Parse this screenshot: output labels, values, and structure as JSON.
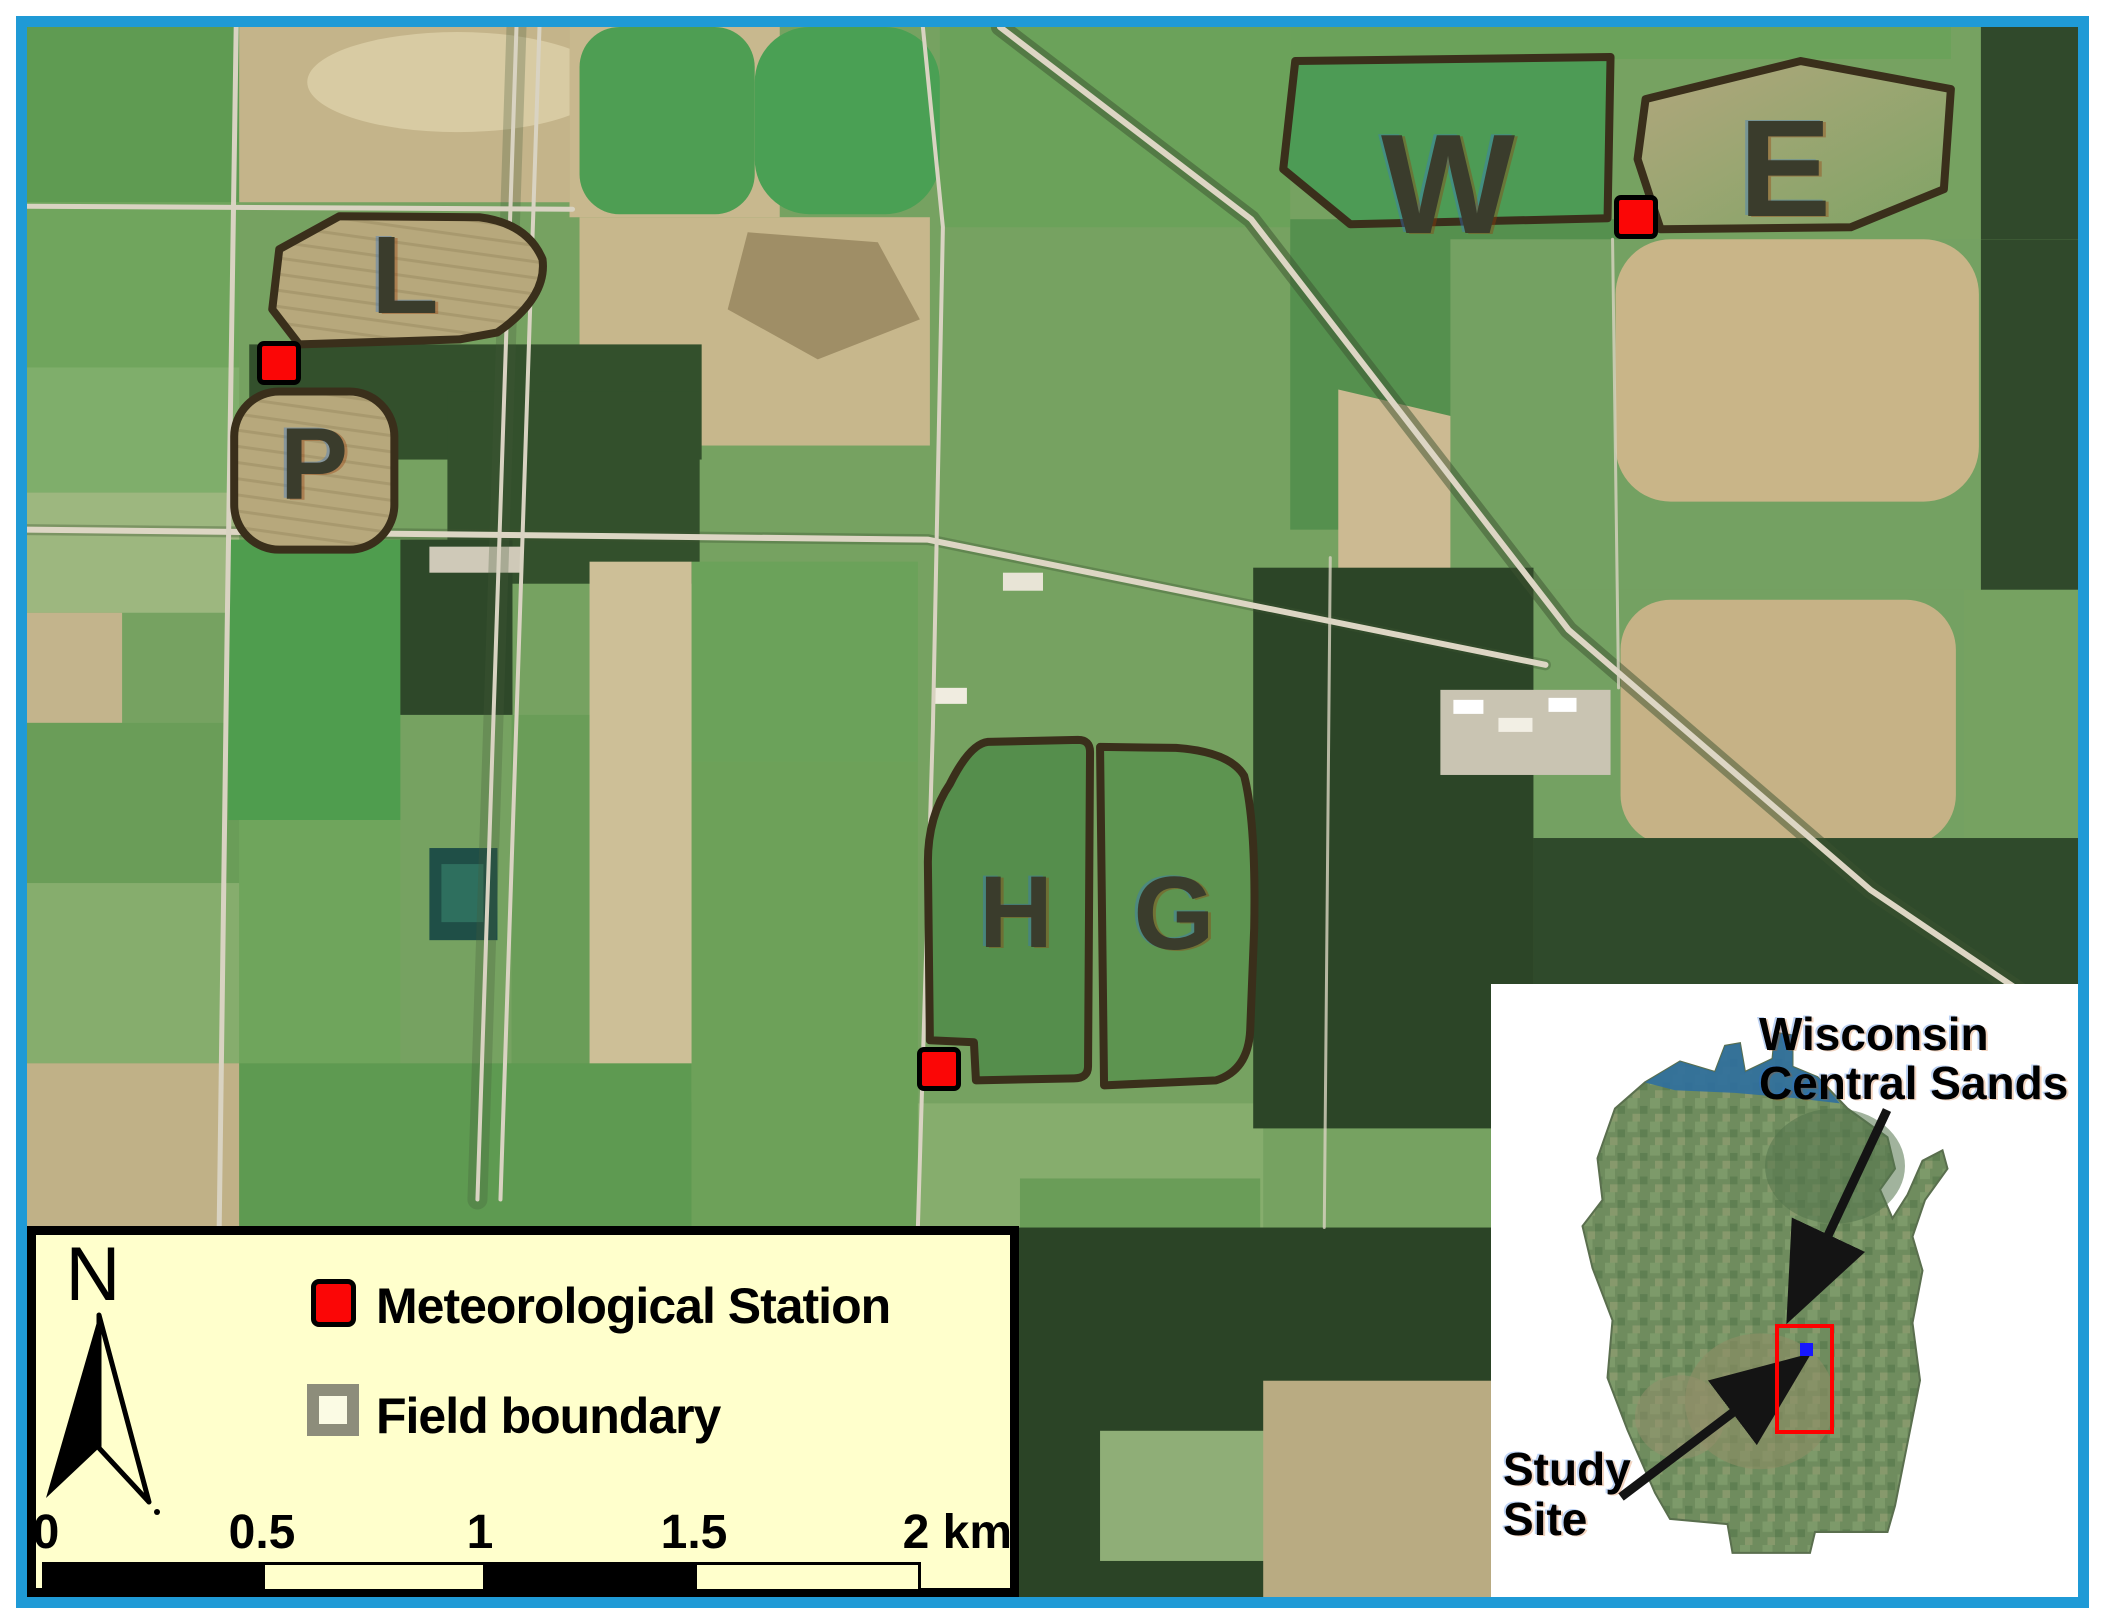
{
  "map": {
    "field_labels": [
      {
        "id": "L",
        "label": "L"
      },
      {
        "id": "P",
        "label": "P"
      },
      {
        "id": "W",
        "label": "W"
      },
      {
        "id": "E",
        "label": "E"
      },
      {
        "id": "H",
        "label": "H"
      },
      {
        "id": "G",
        "label": "G"
      }
    ]
  },
  "legend": {
    "north_label": "N",
    "items": [
      {
        "id": "station",
        "label": "Meteorological Station"
      },
      {
        "id": "boundary",
        "label": "Field boundary"
      }
    ],
    "scalebar": {
      "tick_labels": [
        "0",
        "0.5",
        "1",
        "1.5",
        "2 km"
      ]
    }
  },
  "inset": {
    "region_label": "Wisconsin Central Sands",
    "site_label": "Study Site"
  },
  "colors": {
    "frame": "#1f9ad6",
    "station": "#fb0606",
    "legend_bg": "#ffffcc",
    "boundary_swatch": "#8d8d7b",
    "study_area_rect": "#ff0000",
    "study_site_dot": "#1717ff"
  }
}
